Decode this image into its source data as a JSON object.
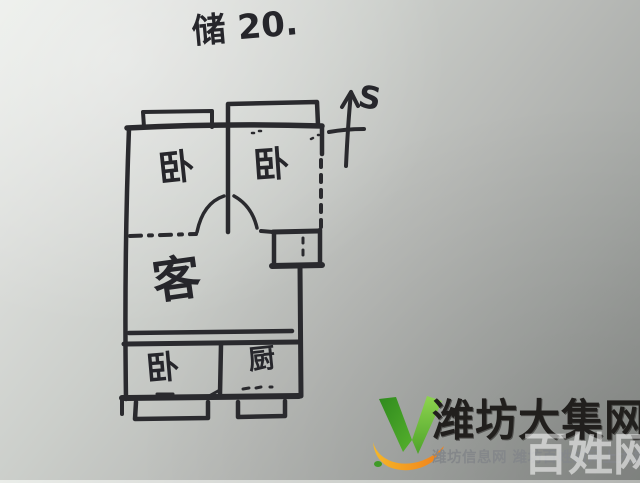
{
  "annotation": {
    "title": "储 20."
  },
  "compass": {
    "label": "S"
  },
  "floor_plan": {
    "type": "hand-drawn apartment sketch",
    "ink_color": "#2a2a2e",
    "rooms": {
      "bedroom_top_left": "卧",
      "bedroom_top_right": "卧",
      "living": "客",
      "bedroom_bottom_left": "卧",
      "kitchen": "厨"
    }
  },
  "logo": {
    "title": "潍坊大集网",
    "subtitle": "潍坊信息网 潍坊百姓的网上大集",
    "watermark": "百姓网",
    "colors": {
      "green_dark": "#2f8a1e",
      "green_light": "#8ed44f",
      "orange": "#f59a1e",
      "title": "#211f1d",
      "subtitle": "#84878a"
    }
  }
}
